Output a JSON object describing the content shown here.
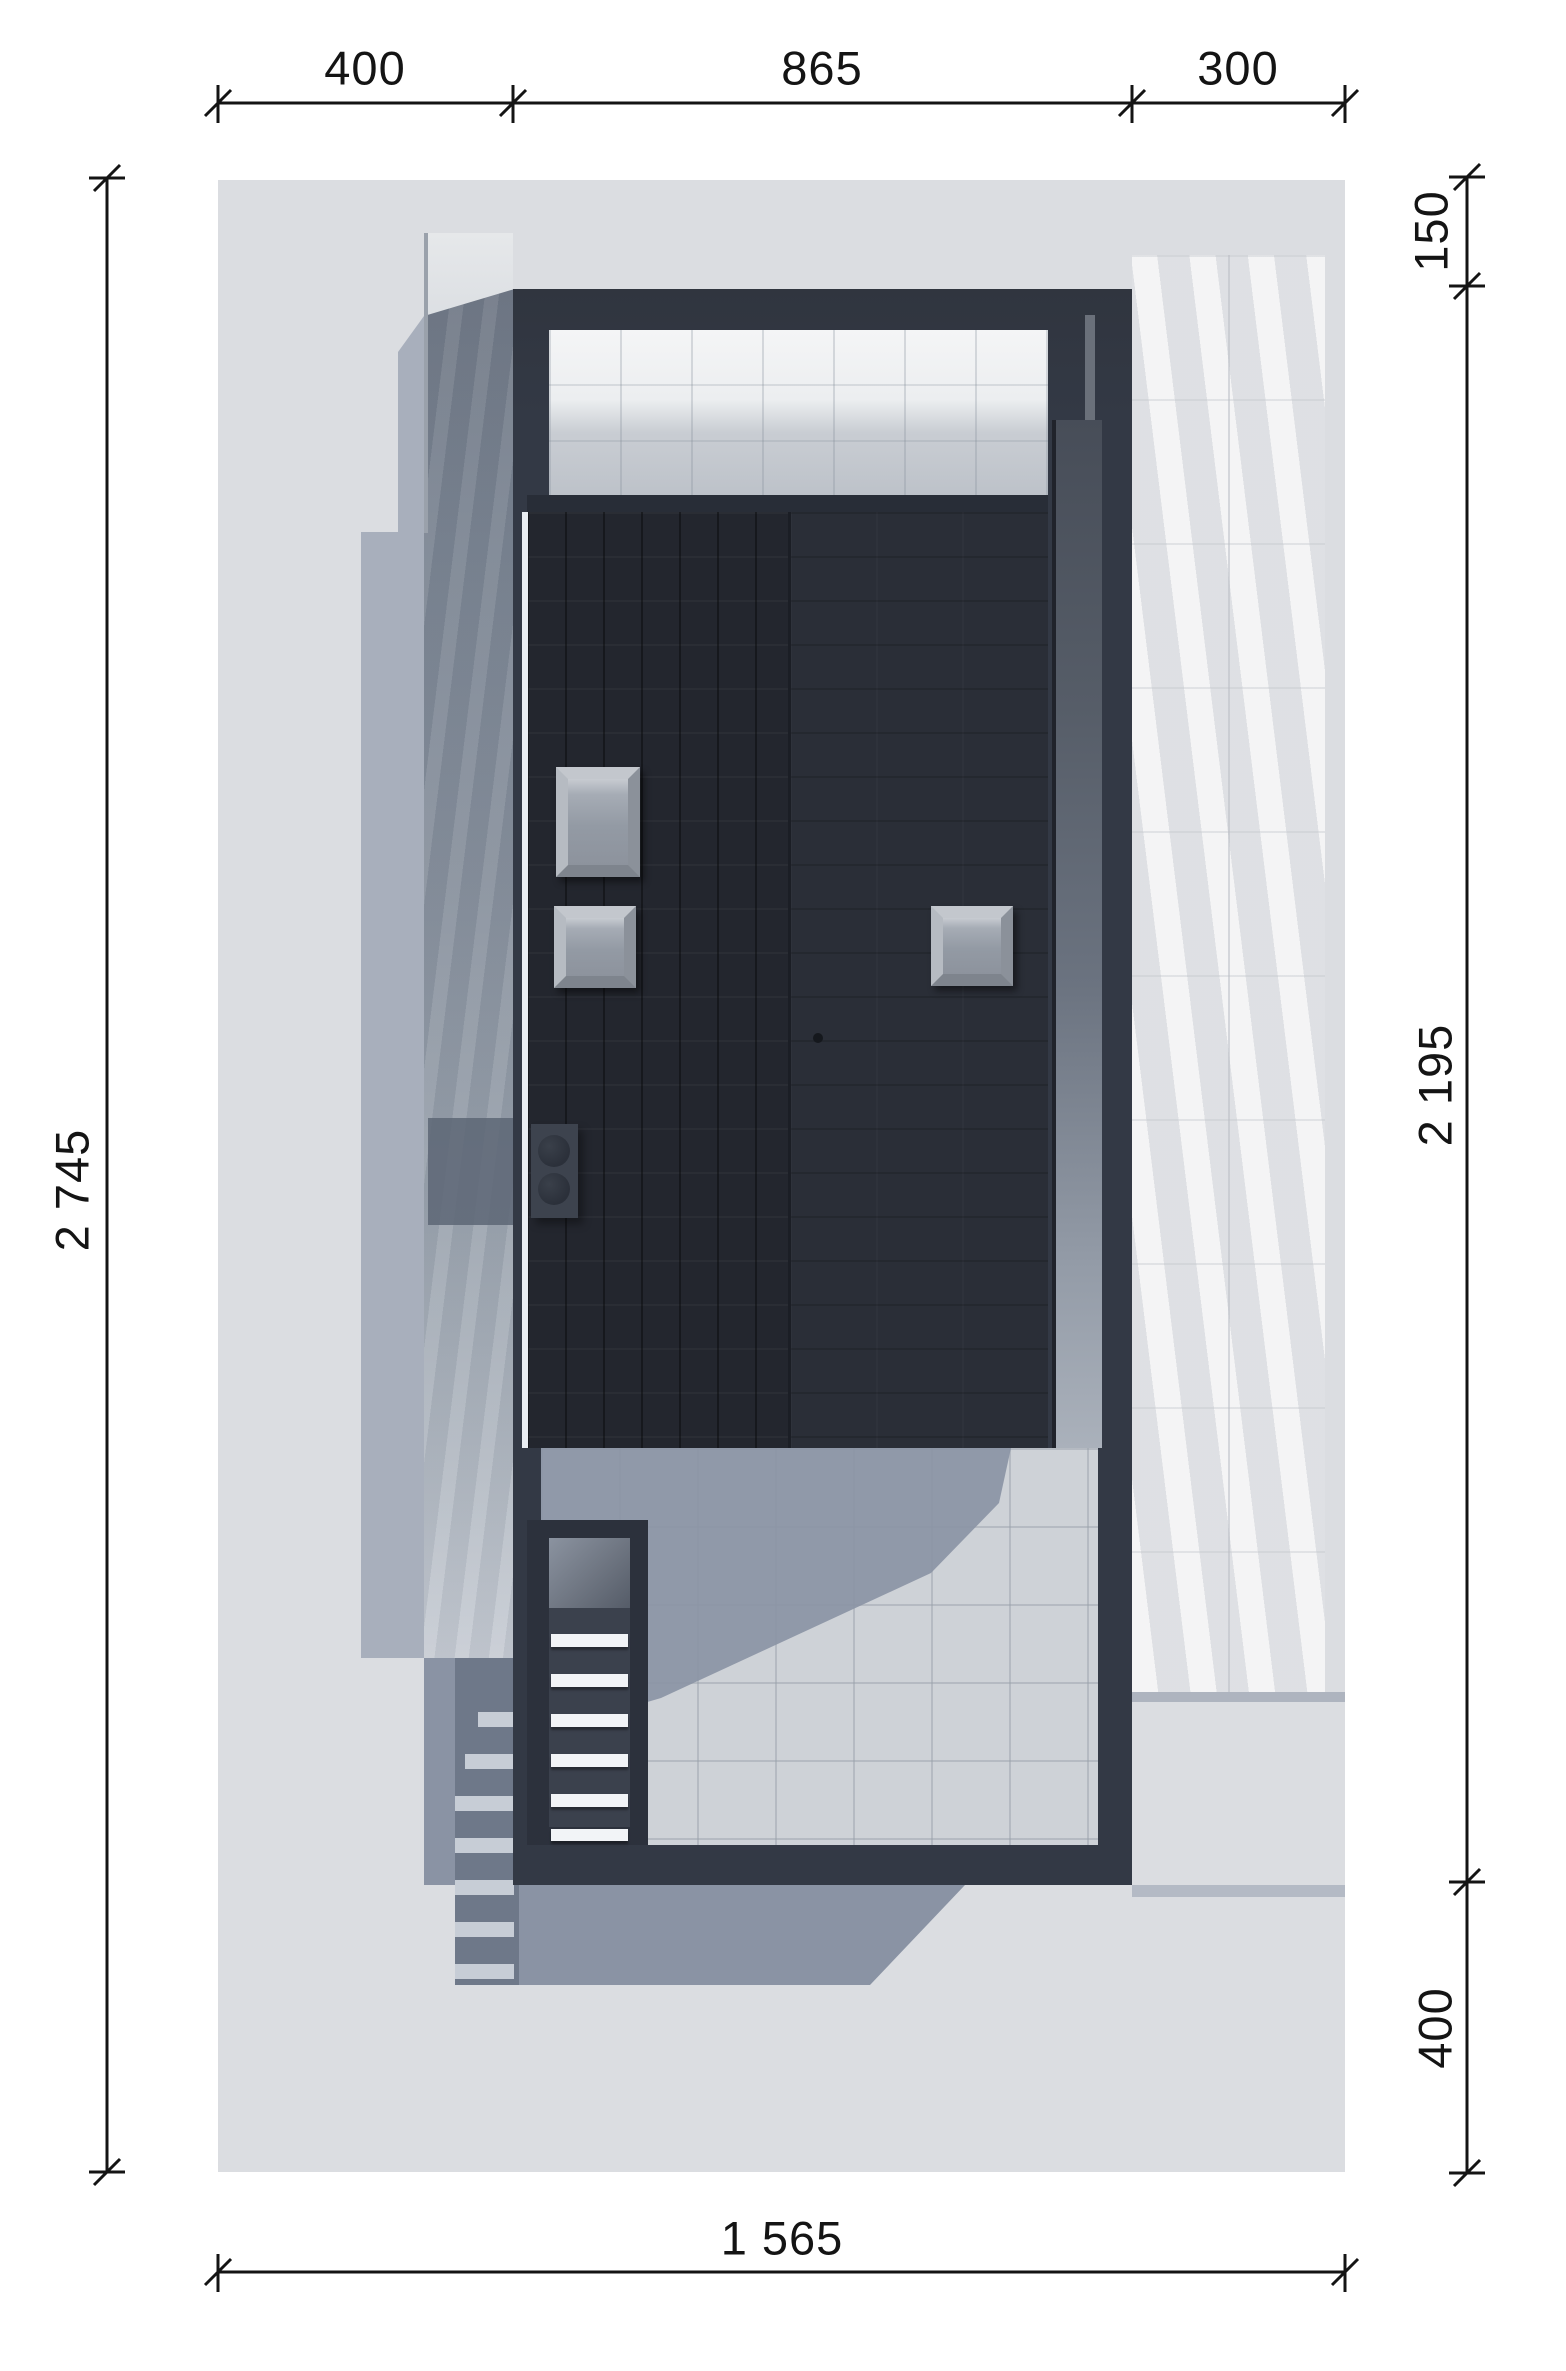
{
  "drawing": {
    "type": "architectural-site-plan-top-view",
    "dimensions": {
      "top": [
        {
          "value": "400"
        },
        {
          "value": "865"
        },
        {
          "value": "300"
        }
      ],
      "left": [
        {
          "value": "2 745"
        }
      ],
      "right": [
        {
          "value": "150"
        },
        {
          "value": "2 195"
        },
        {
          "value": "400"
        }
      ],
      "bottom": [
        {
          "value": "1 565"
        }
      ]
    },
    "skylight_count": 3,
    "colors": {
      "paper": "#ffffff",
      "plot_ground": "#dbdde1",
      "house_wall": "#333945",
      "roof_left_panel": "#23262e",
      "roof_right_panel": "#2a2e37",
      "terrace_light": "#f4f5f6",
      "patio_tile": "#ced2d7",
      "marble_walkway": "#e8e9eb",
      "driveway_shadowed": "#76808e",
      "cast_shadow_light": "#a8afbc",
      "cast_shadow_mid": "#8a93a4",
      "cast_shadow_dark": "#6e7889",
      "skylight_pane": "#939aa4",
      "dimension_ink": "#141414"
    }
  }
}
